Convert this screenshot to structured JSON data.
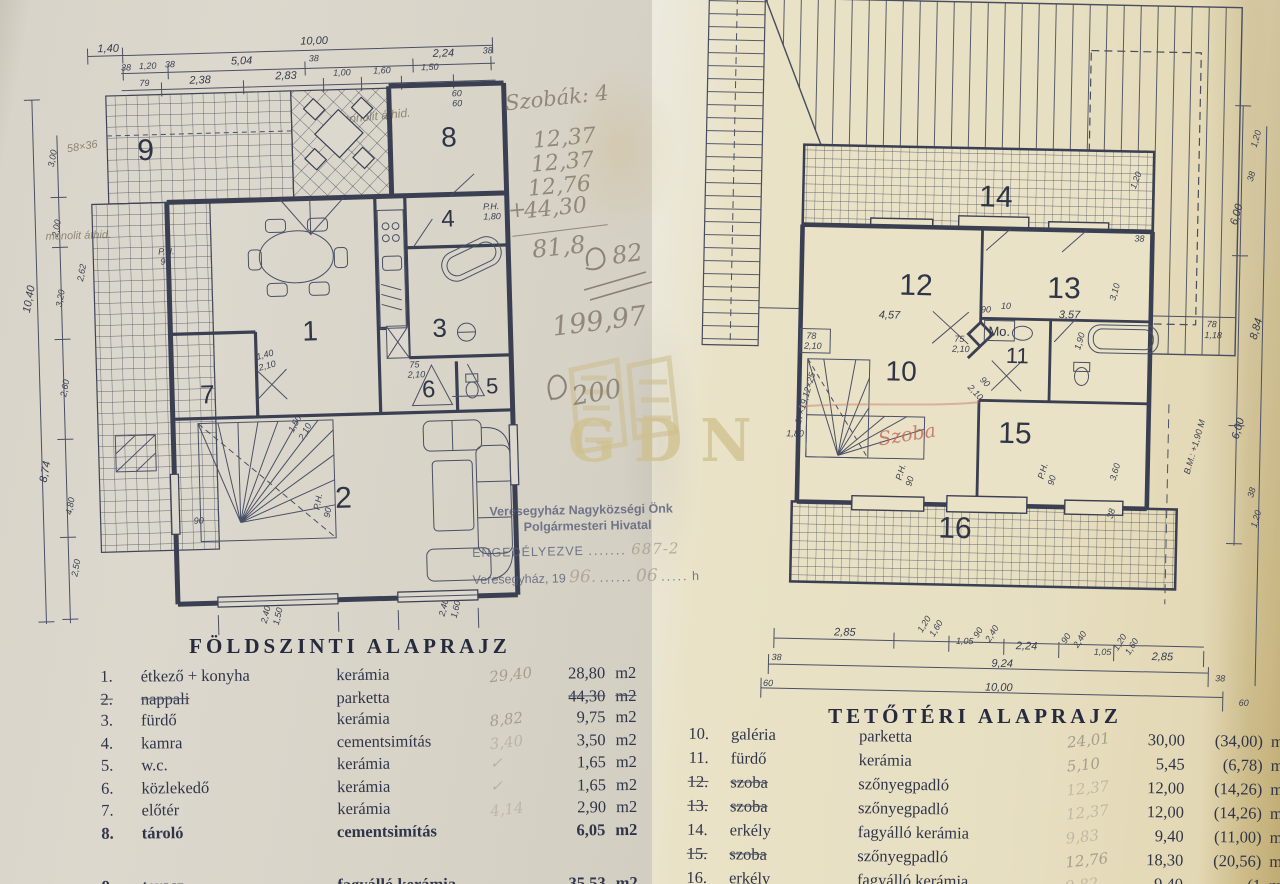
{
  "colors": {
    "ink": "#3a3f52",
    "pencil": "#918879",
    "red_ink": "#bf5f50",
    "watermark": "#cfc08d",
    "paper_left": "#dcd8cd",
    "paper_right": "#e7dfc2"
  },
  "watermark": {
    "text": "GDN"
  },
  "stamp": {
    "line1": "Veresegyház Nagyközségi Önk",
    "line2": "Polgármesteri Hivatal",
    "line3_label": "ENGEDÉLYEZVE",
    "line3_dots": ".......",
    "line3_value": "687-2",
    "line4_prefix": "Veresegyház, 19",
    "line4_year": "96.",
    "line4_dots": "......",
    "line4_month": "06",
    "line4_dots2": ".....",
    "line4_suffix": "h"
  },
  "handnotes": {
    "rooms_label": "Szobák: 4",
    "addends": [
      "12,37",
      "12,37",
      "12,76"
    ],
    "plus": "+",
    "last_addend": "44,30",
    "sum": "81,8",
    "approx": "82",
    "total": "199,97",
    "total_approx": "200"
  },
  "red_note": "Szoba",
  "left_plan": {
    "title": "FÖLDSZINTI ALAPRAJZ",
    "unit": "m2",
    "rooms": [
      "1",
      "2",
      "3",
      "4",
      "5",
      "6",
      "7",
      "8",
      "9"
    ],
    "legend": [
      {
        "no": "1.",
        "name": "étkező + konyha",
        "material": "kerámia",
        "hand": "29,40",
        "value": "28,80"
      },
      {
        "no": "2.",
        "name": "nappali",
        "material": "parketta",
        "hand": "",
        "value": "44,30"
      },
      {
        "no": "3.",
        "name": "fürdő",
        "material": "kerámia",
        "hand": "8,82",
        "value": "9,75"
      },
      {
        "no": "4.",
        "name": "kamra",
        "material": "cementsimítás",
        "hand": "3,40",
        "value": "3,50"
      },
      {
        "no": "5.",
        "name": "w.c.",
        "material": "kerámia",
        "hand": "✓",
        "value": "1,65"
      },
      {
        "no": "6.",
        "name": "közlekedő",
        "material": "kerámia",
        "hand": "✓",
        "value": "1,65"
      },
      {
        "no": "7.",
        "name": "előtér",
        "material": "kerámia",
        "hand": "4,14",
        "value": "2,90"
      },
      {
        "no": "8.",
        "name": "tároló",
        "material": "cementsimítás",
        "hand": "",
        "value": "6,05"
      },
      {
        "no": "9.",
        "name": "terasz",
        "material": "fagyálló kerámia",
        "hand": "",
        "value": "35,53"
      }
    ],
    "dims": [
      "1,40",
      "10,00",
      "38",
      "1,20",
      "38",
      "5,04",
      "38",
      "2,24",
      "38",
      "79",
      "2,38",
      "2,83",
      "1,00",
      "1,60",
      "1,50",
      "10,40",
      "3,00",
      "2,00",
      "3,20",
      "2,62",
      "2,60",
      "8,74",
      "4,80",
      "2,50",
      "58×36",
      "monolit áthid.",
      "monolit áthid.",
      "P.H.",
      "90",
      "P.H.",
      "90",
      "75",
      "2,10",
      "P.H.",
      "1,80",
      "1,40",
      "2,10",
      "2,40",
      "1,50",
      "2,40",
      "1,60",
      "60",
      "60",
      "90",
      "1,50",
      "2,10"
    ]
  },
  "right_plan": {
    "title": "TETŐTÉRI ALAPRAJZ",
    "unit": "m2",
    "mo_label": "Mo.",
    "rooms": [
      "10",
      "11",
      "12",
      "13",
      "14",
      "15",
      "16"
    ],
    "legend": [
      {
        "no": "10.",
        "name": "galéria",
        "material": "parketta",
        "hand": "24,01",
        "value": "30,00",
        "paren": "(34,00)"
      },
      {
        "no": "11.",
        "name": "fürdő",
        "material": "kerámia",
        "hand": "5,10",
        "value": "5,45",
        "paren": "(6,78)"
      },
      {
        "no": "12.",
        "name": "szoba",
        "material": "szőnyegpadló",
        "hand": "12,37",
        "value": "12,00",
        "paren": "(14,26)"
      },
      {
        "no": "13.",
        "name": "szoba",
        "material": "szőnyegpadló",
        "hand": "12,37",
        "value": "12,00",
        "paren": "(14,26)"
      },
      {
        "no": "14.",
        "name": "erkély",
        "material": "fagyálló kerámia",
        "hand": "9,83",
        "value": "9,40",
        "paren": "(11,00)"
      },
      {
        "no": "15.",
        "name": "szoba",
        "material": "szőnyegpadló",
        "hand": "12,76",
        "value": "18,30",
        "paren": "(20,56)"
      },
      {
        "no": "16.",
        "name": "erkély",
        "material": "fagyálló kerámia",
        "hand": "9,82",
        "value": "9,40",
        "paren": "(1"
      }
    ],
    "dims": [
      "4,57",
      "90",
      "10",
      "3,57",
      "3,10",
      "1,20",
      "38",
      "6,00",
      "78",
      "1,18",
      "8,84",
      "6,00",
      "38",
      "1,20",
      "2,85",
      "1,20",
      "1,60",
      "1,05",
      "90",
      "2,40",
      "2,24",
      "90",
      "2,40",
      "1,05",
      "1,20",
      "1,60",
      "2,85",
      "38",
      "9,24",
      "60",
      "10,00",
      "38",
      "60",
      "75",
      "2,10",
      "78",
      "2,10",
      "3,60",
      "38",
      "B.M.: +1,90 M",
      "17×19,12×25",
      "1,90",
      "2,10",
      "90",
      "P.H.",
      "90",
      "P.H.",
      "90",
      "1,80",
      "1,20",
      "38"
    ]
  }
}
